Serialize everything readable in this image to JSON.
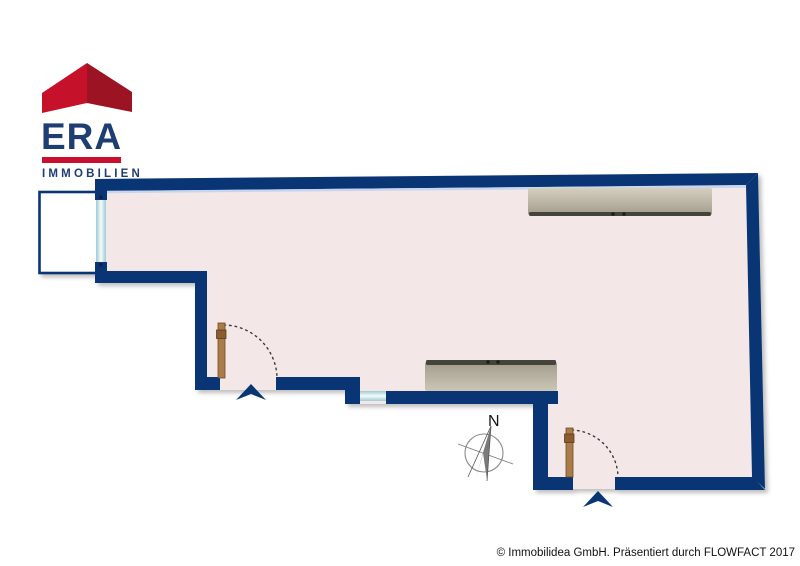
{
  "logo": {
    "brand": "ERA",
    "subtitle": "IMMOBILIEN"
  },
  "compass": {
    "label": "N"
  },
  "footer": {
    "copyright": "© Immobilidea GmbH. Präsentiert durch FLOWFACT 2017"
  },
  "colors": {
    "wall_navy": "#0a3574",
    "floor_pink": "#f3e7e8",
    "wall_inner_highlight": "#c7d6ee",
    "logo_navy": "#1e3d73",
    "logo_red_bright": "#c5112a",
    "logo_red_dark": "#9c1424",
    "logo_bar_red": "#c8102e",
    "window_glass": "#eaf7f3",
    "door_wood": "#aa7c4c",
    "furniture_gray": "#b9b2a2",
    "balcony_fill": "#ffffff"
  },
  "floorplan": {
    "elements": [
      "balcony",
      "window-vertical",
      "window-horizontal",
      "entrance-door-left",
      "entrance-door-right",
      "sideboard-top",
      "sideboard-middle",
      "compass-rose"
    ]
  }
}
